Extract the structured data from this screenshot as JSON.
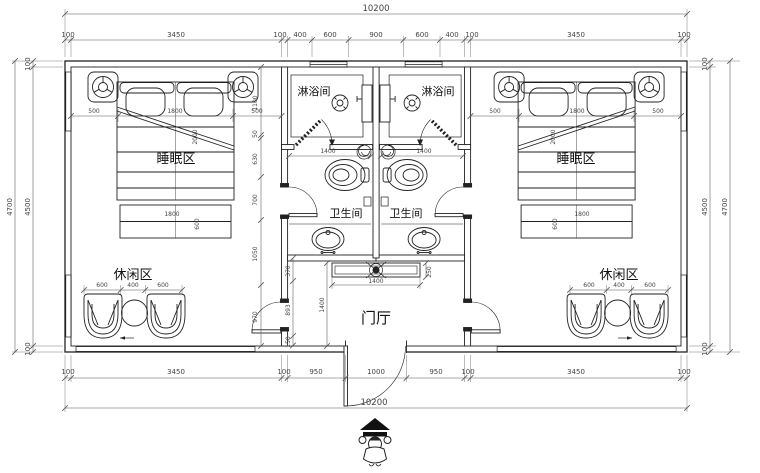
{
  "drawing": {
    "labels": {
      "sleep": "睡眠区",
      "leisure": "休闲区",
      "shower": "淋浴间",
      "toilet": "卫生间",
      "hall": "门厅"
    },
    "dims": {
      "top_total": "10200",
      "top_chain": [
        "100",
        "3450",
        "100",
        "400",
        "600",
        "900",
        "600",
        "400",
        "100",
        "3450",
        "100"
      ],
      "bottom_chain": [
        "100",
        "3450",
        "100",
        "950",
        "1000",
        "950",
        "100",
        "3450",
        "100"
      ],
      "bottom_total": "10200",
      "left_outer": "4700",
      "left_chain": [
        "100",
        "4500",
        "100"
      ],
      "right_outer": "4700",
      "right_chain": [
        "100",
        "4500",
        "100"
      ],
      "bed_chain": [
        "500",
        "1800",
        "500"
      ],
      "bed_diag": "2000",
      "bench_w": "1800",
      "bench_d": "600",
      "side_chain": [
        "1100",
        "50",
        "630",
        "700",
        "1050",
        "970"
      ],
      "leisure_chain": [
        "600",
        "400",
        "600"
      ],
      "bath_w": "1400",
      "cabinet_w": "1400",
      "cabinet_d": "250",
      "hall_depth": "1400",
      "hall_chain": [
        "370",
        "893",
        "150"
      ]
    }
  }
}
